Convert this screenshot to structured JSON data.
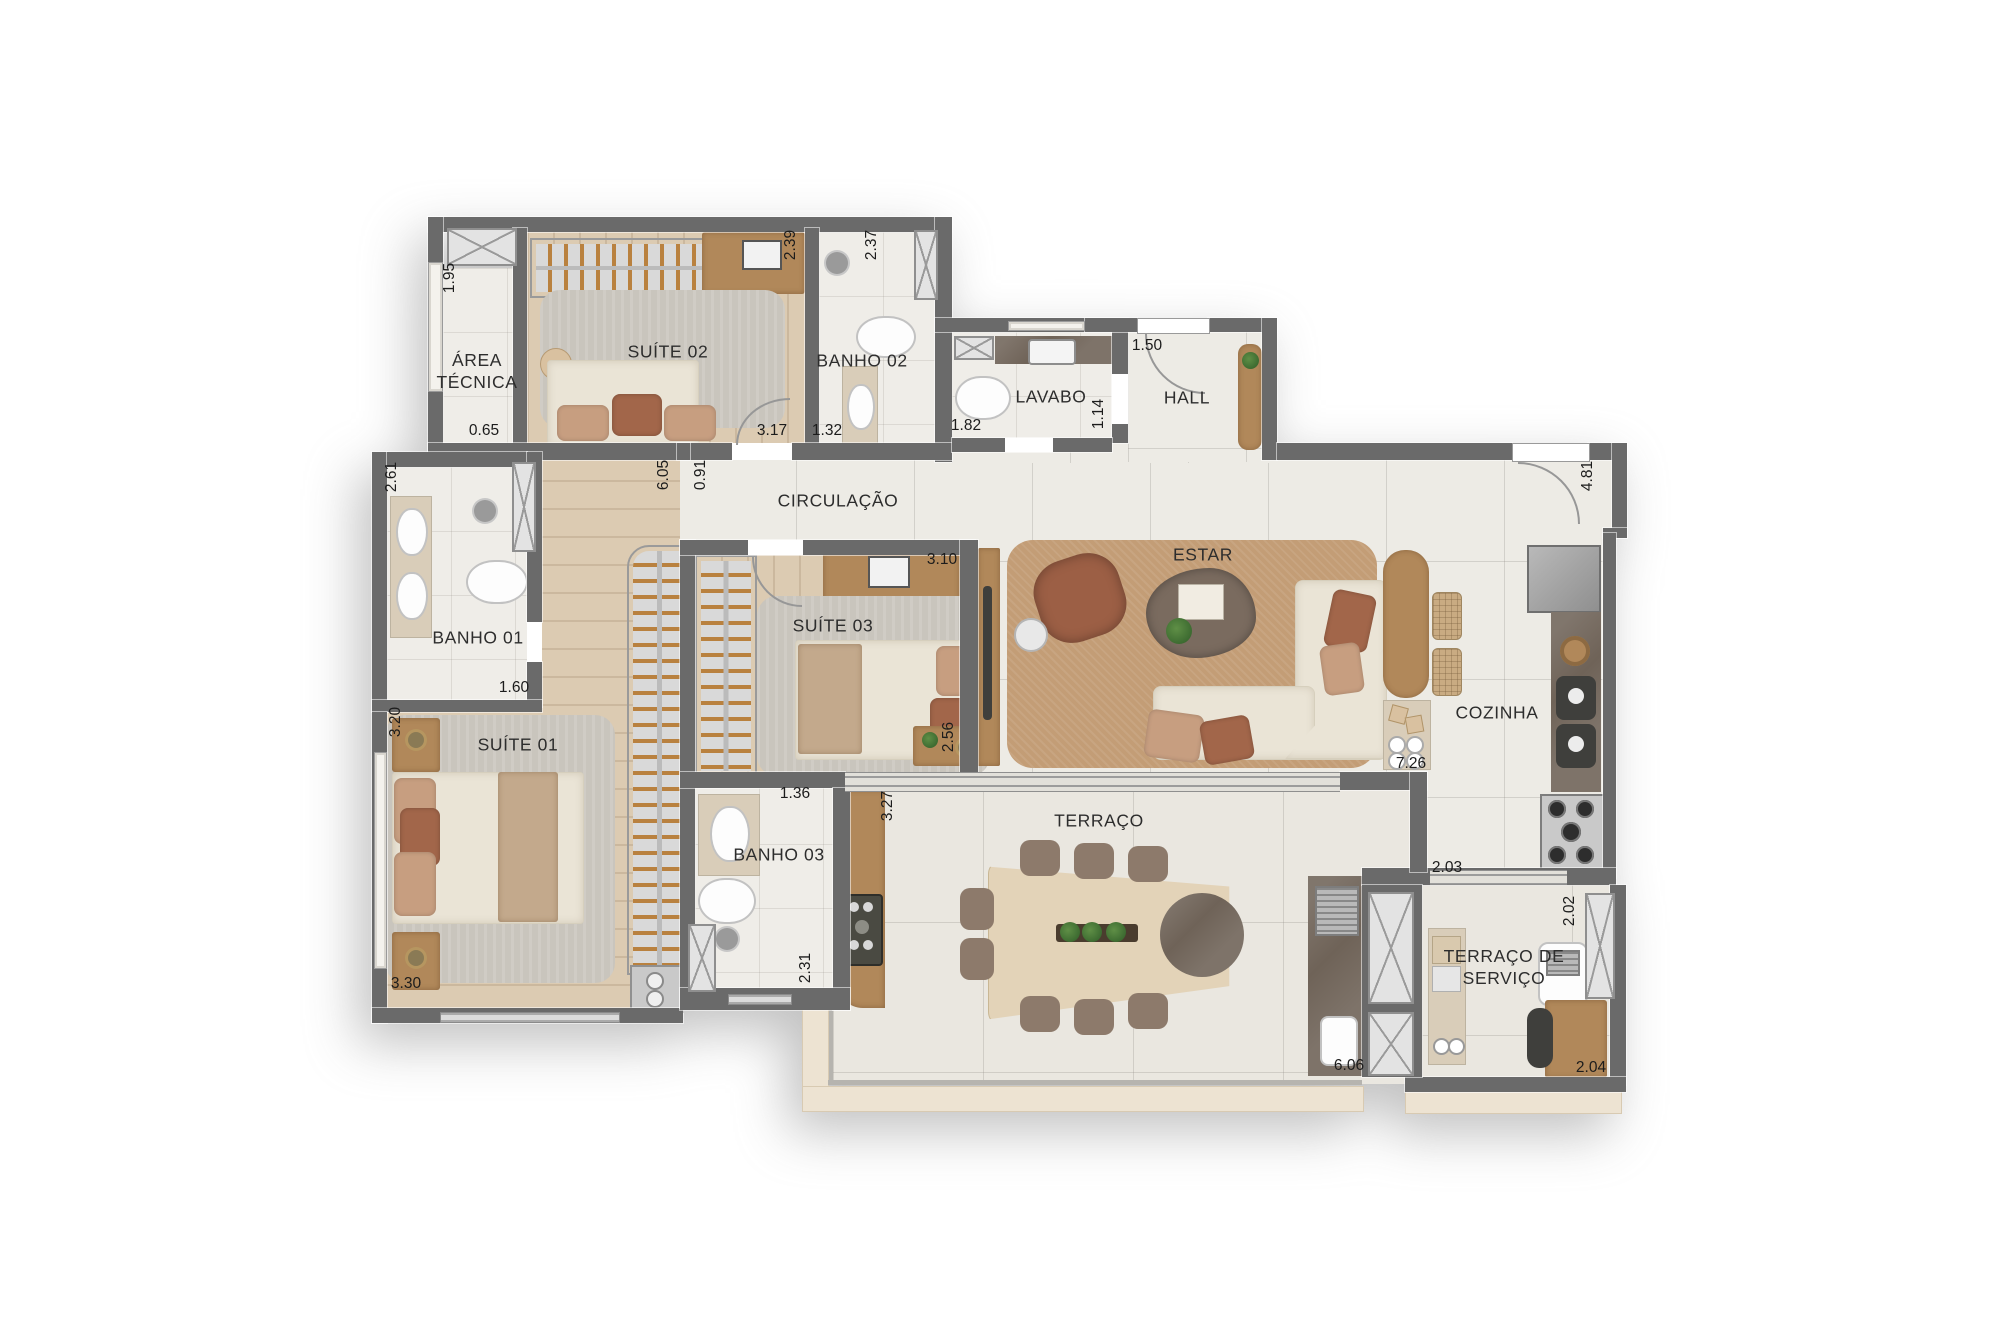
{
  "plan_title": "Apartment floor plan",
  "rooms": {
    "area_tecnica": "ÁREA TÉCNICA",
    "suite02": "SUÍTE 02",
    "banho02": "BANHO 02",
    "lavabo": "LAVABO",
    "hall": "HALL",
    "circulacao": "CIRCULAÇÃO",
    "banho01": "BANHO 01",
    "suite01": "SUÍTE 01",
    "suite03": "SUÍTE 03",
    "banho03": "BANHO 03",
    "estar": "ESTAR",
    "cozinha": "COZINHA",
    "terraco": "TERRAÇO",
    "terraco_servico": "TERRAÇO DE SERVIÇO"
  },
  "dims": [
    {
      "v": "1.95"
    },
    {
      "v": "0.65"
    },
    {
      "v": "2.39"
    },
    {
      "v": "3.17"
    },
    {
      "v": "2.37"
    },
    {
      "v": "1.32"
    },
    {
      "v": "1.82"
    },
    {
      "v": "1.14"
    },
    {
      "v": "1.50"
    },
    {
      "v": "4.81"
    },
    {
      "v": "2.61"
    },
    {
      "v": "1.60"
    },
    {
      "v": "6.05"
    },
    {
      "v": "0.91"
    },
    {
      "v": "3.20"
    },
    {
      "v": "3.30"
    },
    {
      "v": "3.10"
    },
    {
      "v": "2.56"
    },
    {
      "v": "1.36"
    },
    {
      "v": "2.31"
    },
    {
      "v": "3.27"
    },
    {
      "v": "7.26"
    },
    {
      "v": "6.06"
    },
    {
      "v": "2.03"
    },
    {
      "v": "2.02"
    },
    {
      "v": "2.04"
    }
  ],
  "colors": {
    "wall": "#6a6a6a",
    "tile_floor": "#edebe5",
    "wood_floor": "#dccbb2",
    "terrace_floor": "#eae7e0",
    "estar_rug": "#c39d76",
    "gray_rug": "#c9c5bd",
    "furniture_wood": "#b1885a",
    "marble": "#6f6358",
    "cream_upholstery": "#eae4d6",
    "rust_pillow": "#a2664a",
    "balcony_band": "#ede3d2"
  }
}
